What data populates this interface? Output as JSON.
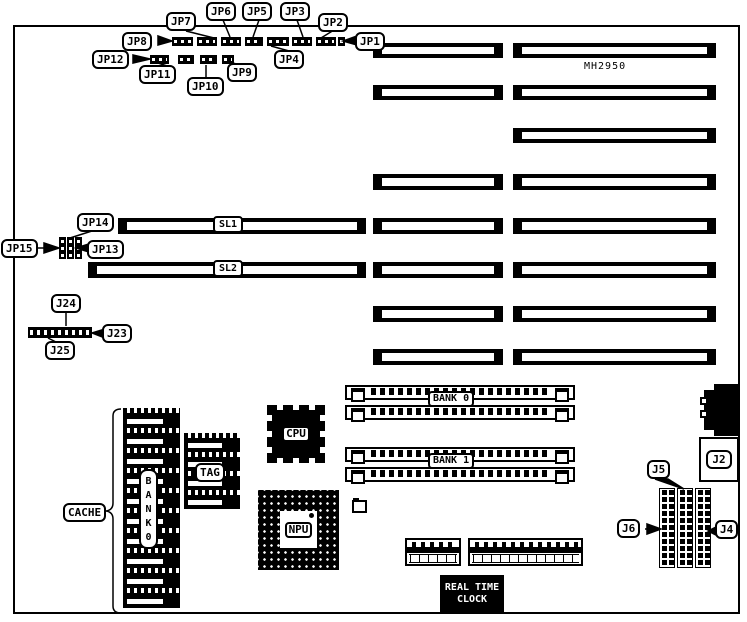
{
  "board": {
    "model": "MH2950"
  },
  "jumpers": {
    "jp1": "JP1",
    "jp2": "JP2",
    "jp3": "JP3",
    "jp4": "JP4",
    "jp5": "JP5",
    "jp6": "JP6",
    "jp7": "JP7",
    "jp8": "JP8",
    "jp9": "JP9",
    "jp10": "JP10",
    "jp11": "JP11",
    "jp12": "JP12",
    "jp13": "JP13",
    "jp14": "JP14",
    "jp15": "JP15"
  },
  "slots": {
    "sl1": "SL1",
    "sl2": "SL2"
  },
  "memory": {
    "bank0": "BANK 0",
    "bank1": "BANK 1",
    "cache": "CACHE",
    "cache_bank": "BANK0",
    "tag": "TAG"
  },
  "chips": {
    "cpu": "CPU",
    "npu": "NPU"
  },
  "connectors": {
    "j2": "J2",
    "j4": "J4",
    "j5": "J5",
    "j6": "J6",
    "j23": "J23",
    "j24": "J24",
    "j25": "J25"
  },
  "rtc": {
    "line1": "REAL TIME",
    "line2": "CLOCK"
  },
  "colors": {
    "ink": "#000000",
    "paper": "#ffffff"
  }
}
